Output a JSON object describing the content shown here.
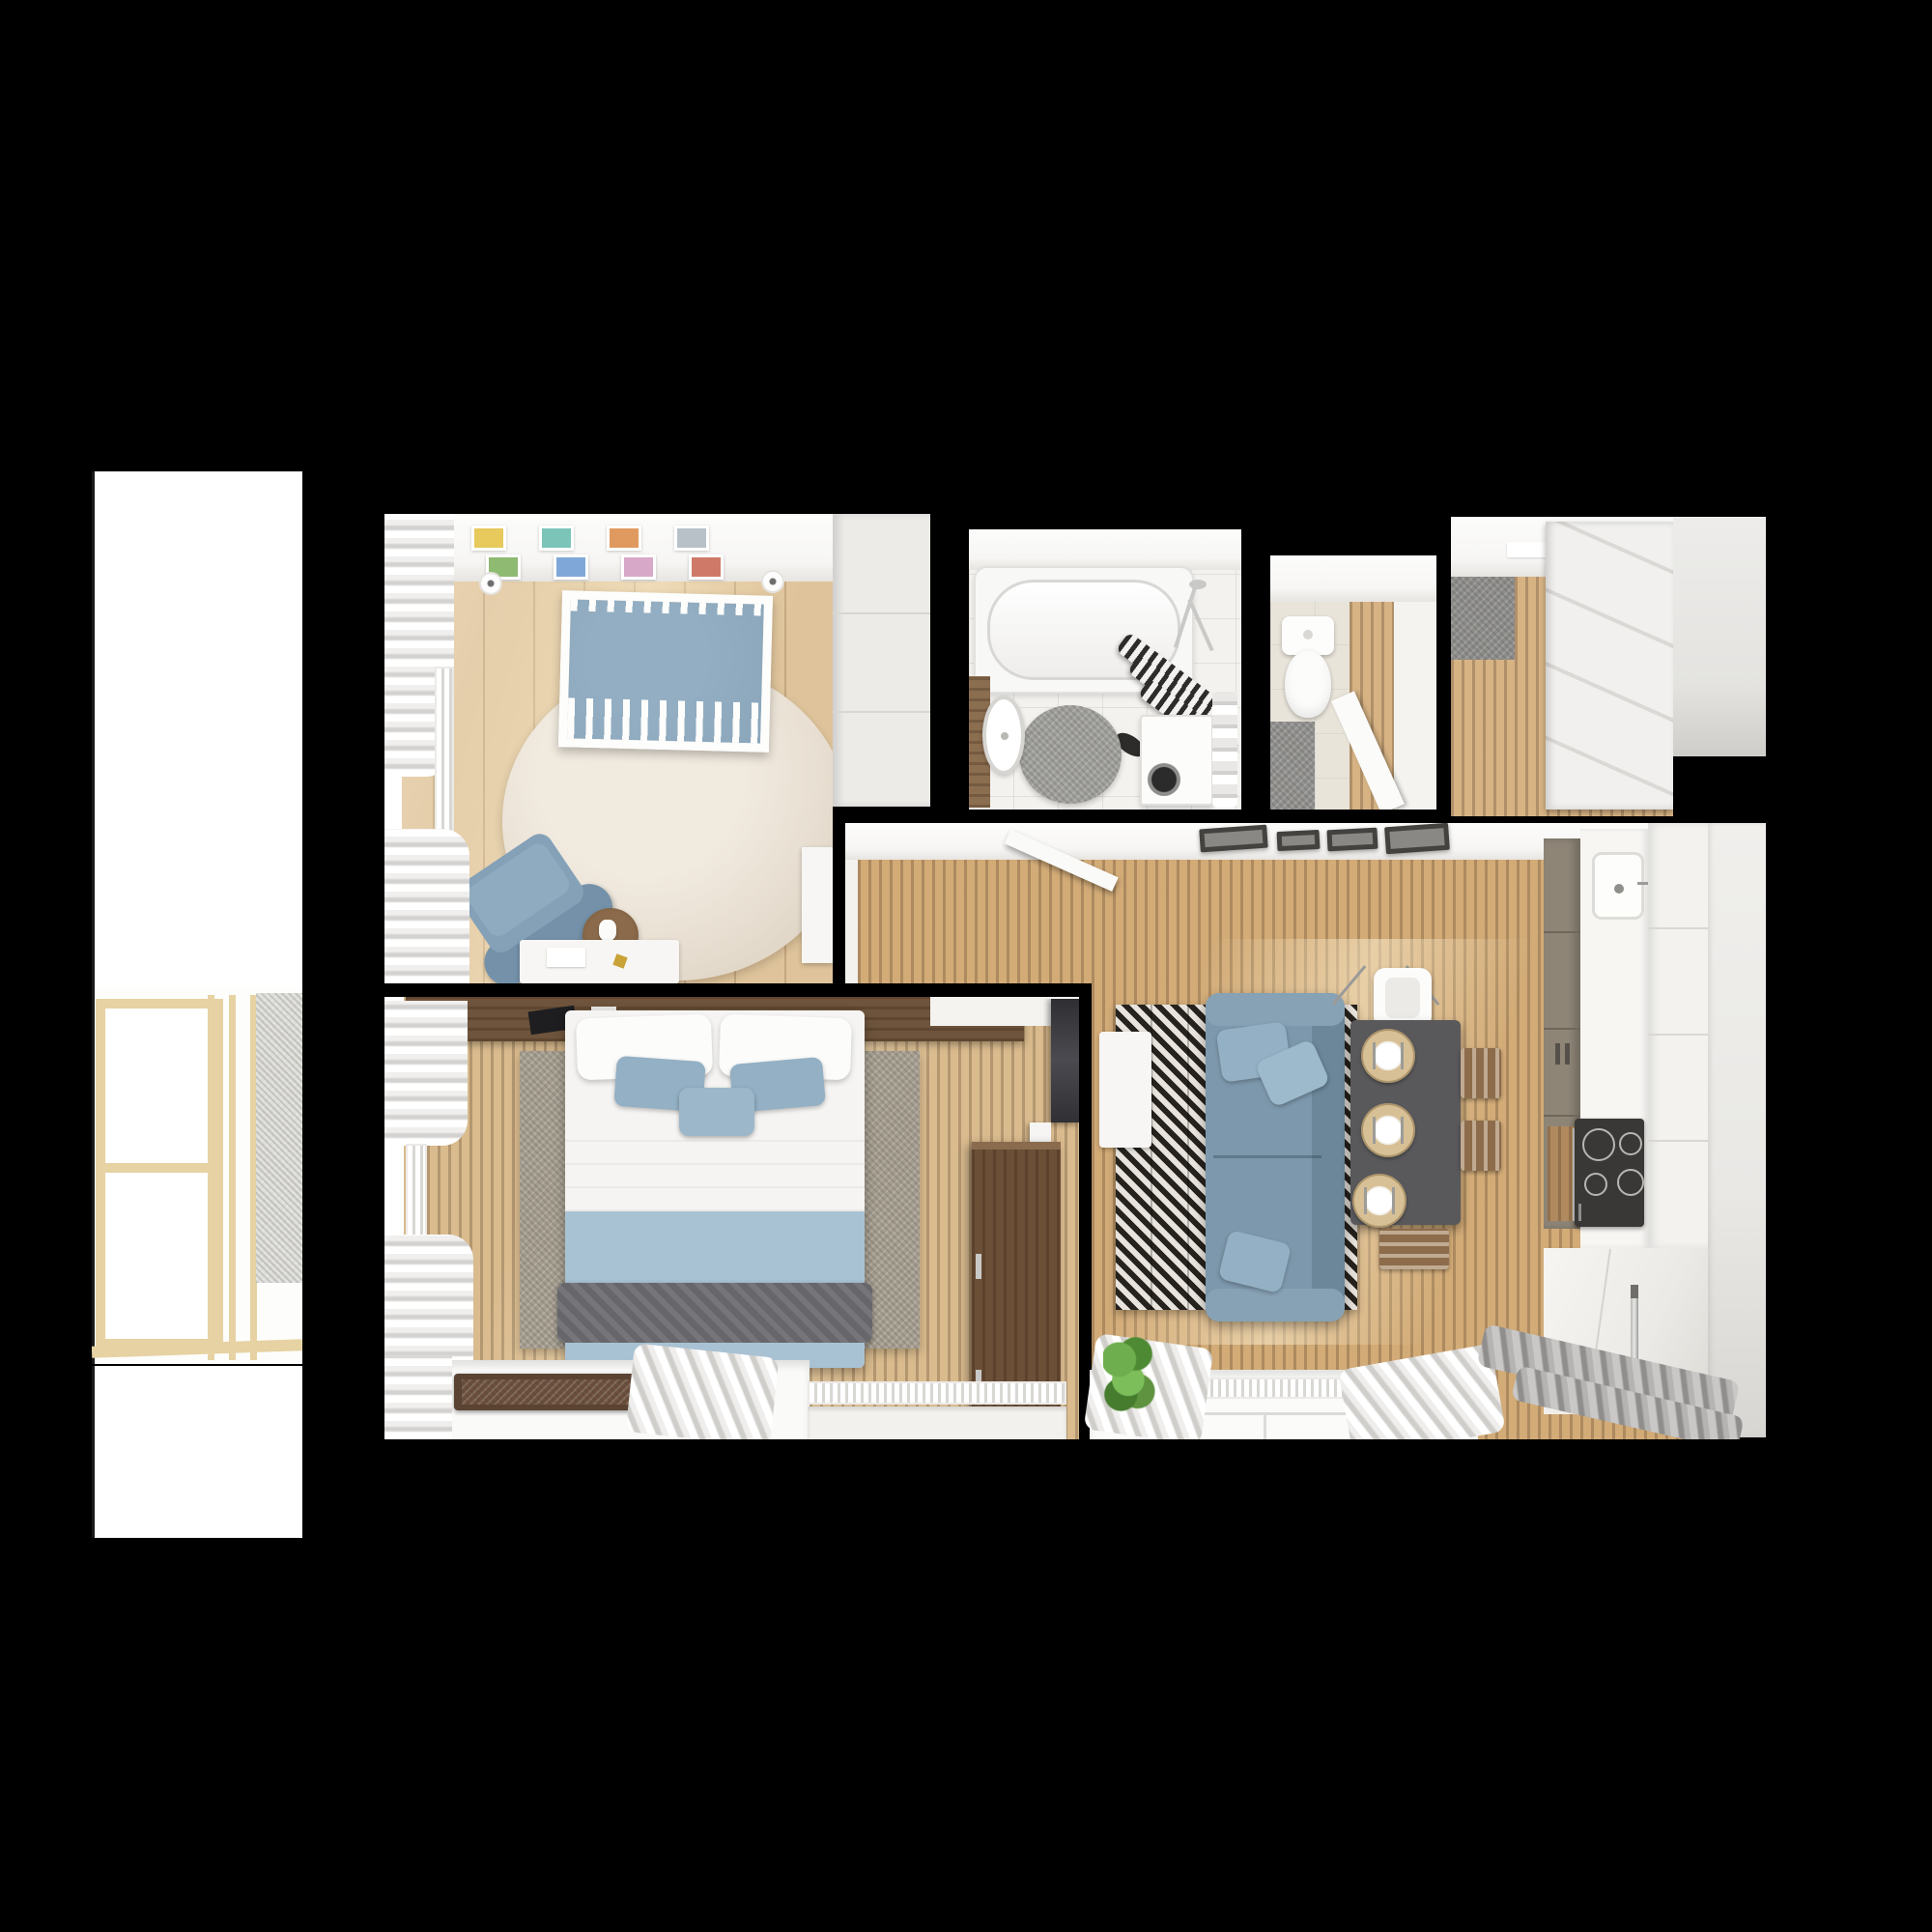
{
  "scene": {
    "title": "apartment-floor-plan-top-down-render",
    "background": "#000000",
    "rooms": [
      {
        "id": "balcony",
        "label": "Balcony",
        "items": [
          "glazed-window-frames",
          "concrete-wall-panel"
        ]
      },
      {
        "id": "nursery",
        "label": "Nursery",
        "items": [
          "crib",
          "round-rug",
          "nursing-armchair",
          "side-table",
          "desk",
          "wardrobe",
          "wall-art-frames",
          "ceiling-spotlights",
          "window-curtains",
          "radiator"
        ]
      },
      {
        "id": "bathroom",
        "label": "Bathroom",
        "items": [
          "bathtub",
          "striped-shower-curtain",
          "washing-machine",
          "round-rug",
          "sink-vanity",
          "towel-rail",
          "shower-fixture"
        ]
      },
      {
        "id": "wc",
        "label": "WC",
        "items": [
          "toilet",
          "floor-mat",
          "open-door"
        ]
      },
      {
        "id": "hallway",
        "label": "Entry Hall",
        "items": [
          "doormat",
          "sliding-wardrobe",
          "cabinet-column"
        ]
      },
      {
        "id": "living-kitchen",
        "label": "Living Room + Kitchen",
        "items": [
          "sofa",
          "sofa-pillows",
          "herringbone-rug",
          "tv-stand",
          "dining-table",
          "placemats",
          "dining-chairs",
          "high-chair",
          "ceiling-lights",
          "kitchen-cabinets",
          "kitchen-sink",
          "cooktop",
          "oven",
          "fridge",
          "window-curtains",
          "radiator",
          "plant",
          "open-door"
        ]
      },
      {
        "id": "bedroom",
        "label": "Bedroom",
        "items": [
          "double-bed",
          "pillows",
          "blue-blanket",
          "gray-throw",
          "area-rug",
          "headboard-shelf",
          "wall-tv",
          "dresser",
          "door",
          "window-sill",
          "serving-tray",
          "window-curtains",
          "radiators"
        ]
      }
    ]
  },
  "palette": {
    "bg": "#000000",
    "white_wall": "#f6f5f3",
    "ceiling": "#fafaf9",
    "wood_light": "#dfc49b",
    "wood_living": "#d2ab77",
    "wood_bedroom": "#dabb8e",
    "wood_hall": "#d7b384",
    "wood_balcony_frame": "#e6d2a2",
    "wardrobe_white": "#ecebe8",
    "rug_round": "#e8dfd2",
    "rug_bedroom": "#a59e90",
    "rug_herringbone_dark": "#26221e",
    "rug_herringbone_light": "#e8e4dd",
    "crib_blue": "#8ba6bb",
    "armchair_blue": "#84a1b8",
    "sofa_blue": "#7d98ac",
    "sofa_blue_dark": "#6b8799",
    "pillow_blue": "#93b0c4",
    "bed_blue": "#a9c2d3",
    "throw_gray": "#67676b",
    "table_dark": "#59595c",
    "chair_wood": "#8c6c4b",
    "placemat_tan": "#d8c096",
    "cabinet_taupe": "#8e8577",
    "cooktop_black": "#3a3836",
    "counter_white": "#f7f6f3",
    "dresser_wood": "#6b4f37",
    "headboard_wood": "#6e543c",
    "tv_black": "#3a3a3e",
    "doormat_gray": "#8c8c8a",
    "tile_beige": "#e9e4da",
    "tile_white": "#f3f2ef",
    "mat_gray": "#90908e",
    "plant_green": "#5f9340",
    "tray_brown": "#5a4333",
    "chrome": "#c9c9c7",
    "stripe_dark": "#2e2c2a",
    "art_yellow": "#e7c95c",
    "art_green": "#8fba72",
    "art_blue": "#7fa8d8",
    "art_orange": "#e09a5f",
    "art_red": "#cf7a68",
    "art_teal": "#7cc4b8",
    "art_pink": "#d8a8c8",
    "art_gray": "#b8c0c8"
  }
}
